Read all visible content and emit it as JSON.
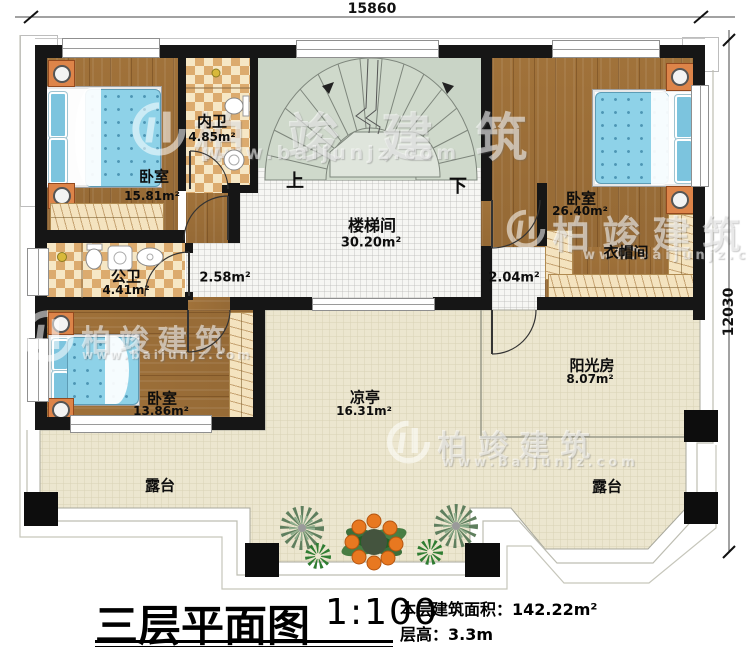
{
  "title_block": {
    "title": "三层平面图",
    "scale": "1:100",
    "area_label": "本层建筑面积：",
    "area_value": "142.22m²",
    "height_label": "层高：",
    "height_value": "3.3m"
  },
  "dimensions": {
    "width": "15860",
    "height": "12030"
  },
  "stairs": {
    "up": "上",
    "down": "下"
  },
  "watermark": {
    "brand": "柏竣建筑",
    "url": "www.baijunjz.com"
  },
  "rooms": {
    "bedroom1": {
      "name": "卧室",
      "area": "15.81m²"
    },
    "inner_bath": {
      "name": "内卫",
      "area": "4.85m²"
    },
    "public_bath": {
      "name": "公卫",
      "area": "4.41m²"
    },
    "stairwell": {
      "name": "楼梯间",
      "area": "30.20m²"
    },
    "hall_left": {
      "area": "2.58m²"
    },
    "hall_right": {
      "area": "2.04m²"
    },
    "bedroom2": {
      "name": "卧室",
      "area": "26.40m²"
    },
    "cloakroom": {
      "name": "衣帽间"
    },
    "bedroom3": {
      "name": "卧室",
      "area": "13.86m²"
    },
    "sunroom": {
      "name": "阳光房",
      "area": "8.07m²"
    },
    "pavilion": {
      "name": "凉亭",
      "area": "16.31m²"
    },
    "terrace": {
      "name": "露台"
    }
  },
  "colors": {
    "wall": "#161616",
    "wood": "#a6783f",
    "tile_light": "#f6e7c5",
    "tile_dark": "#dcab6e",
    "bed": "#8ed2e8",
    "terrace_floor": "#ece6cf",
    "stair": "#ccd7c9"
  }
}
